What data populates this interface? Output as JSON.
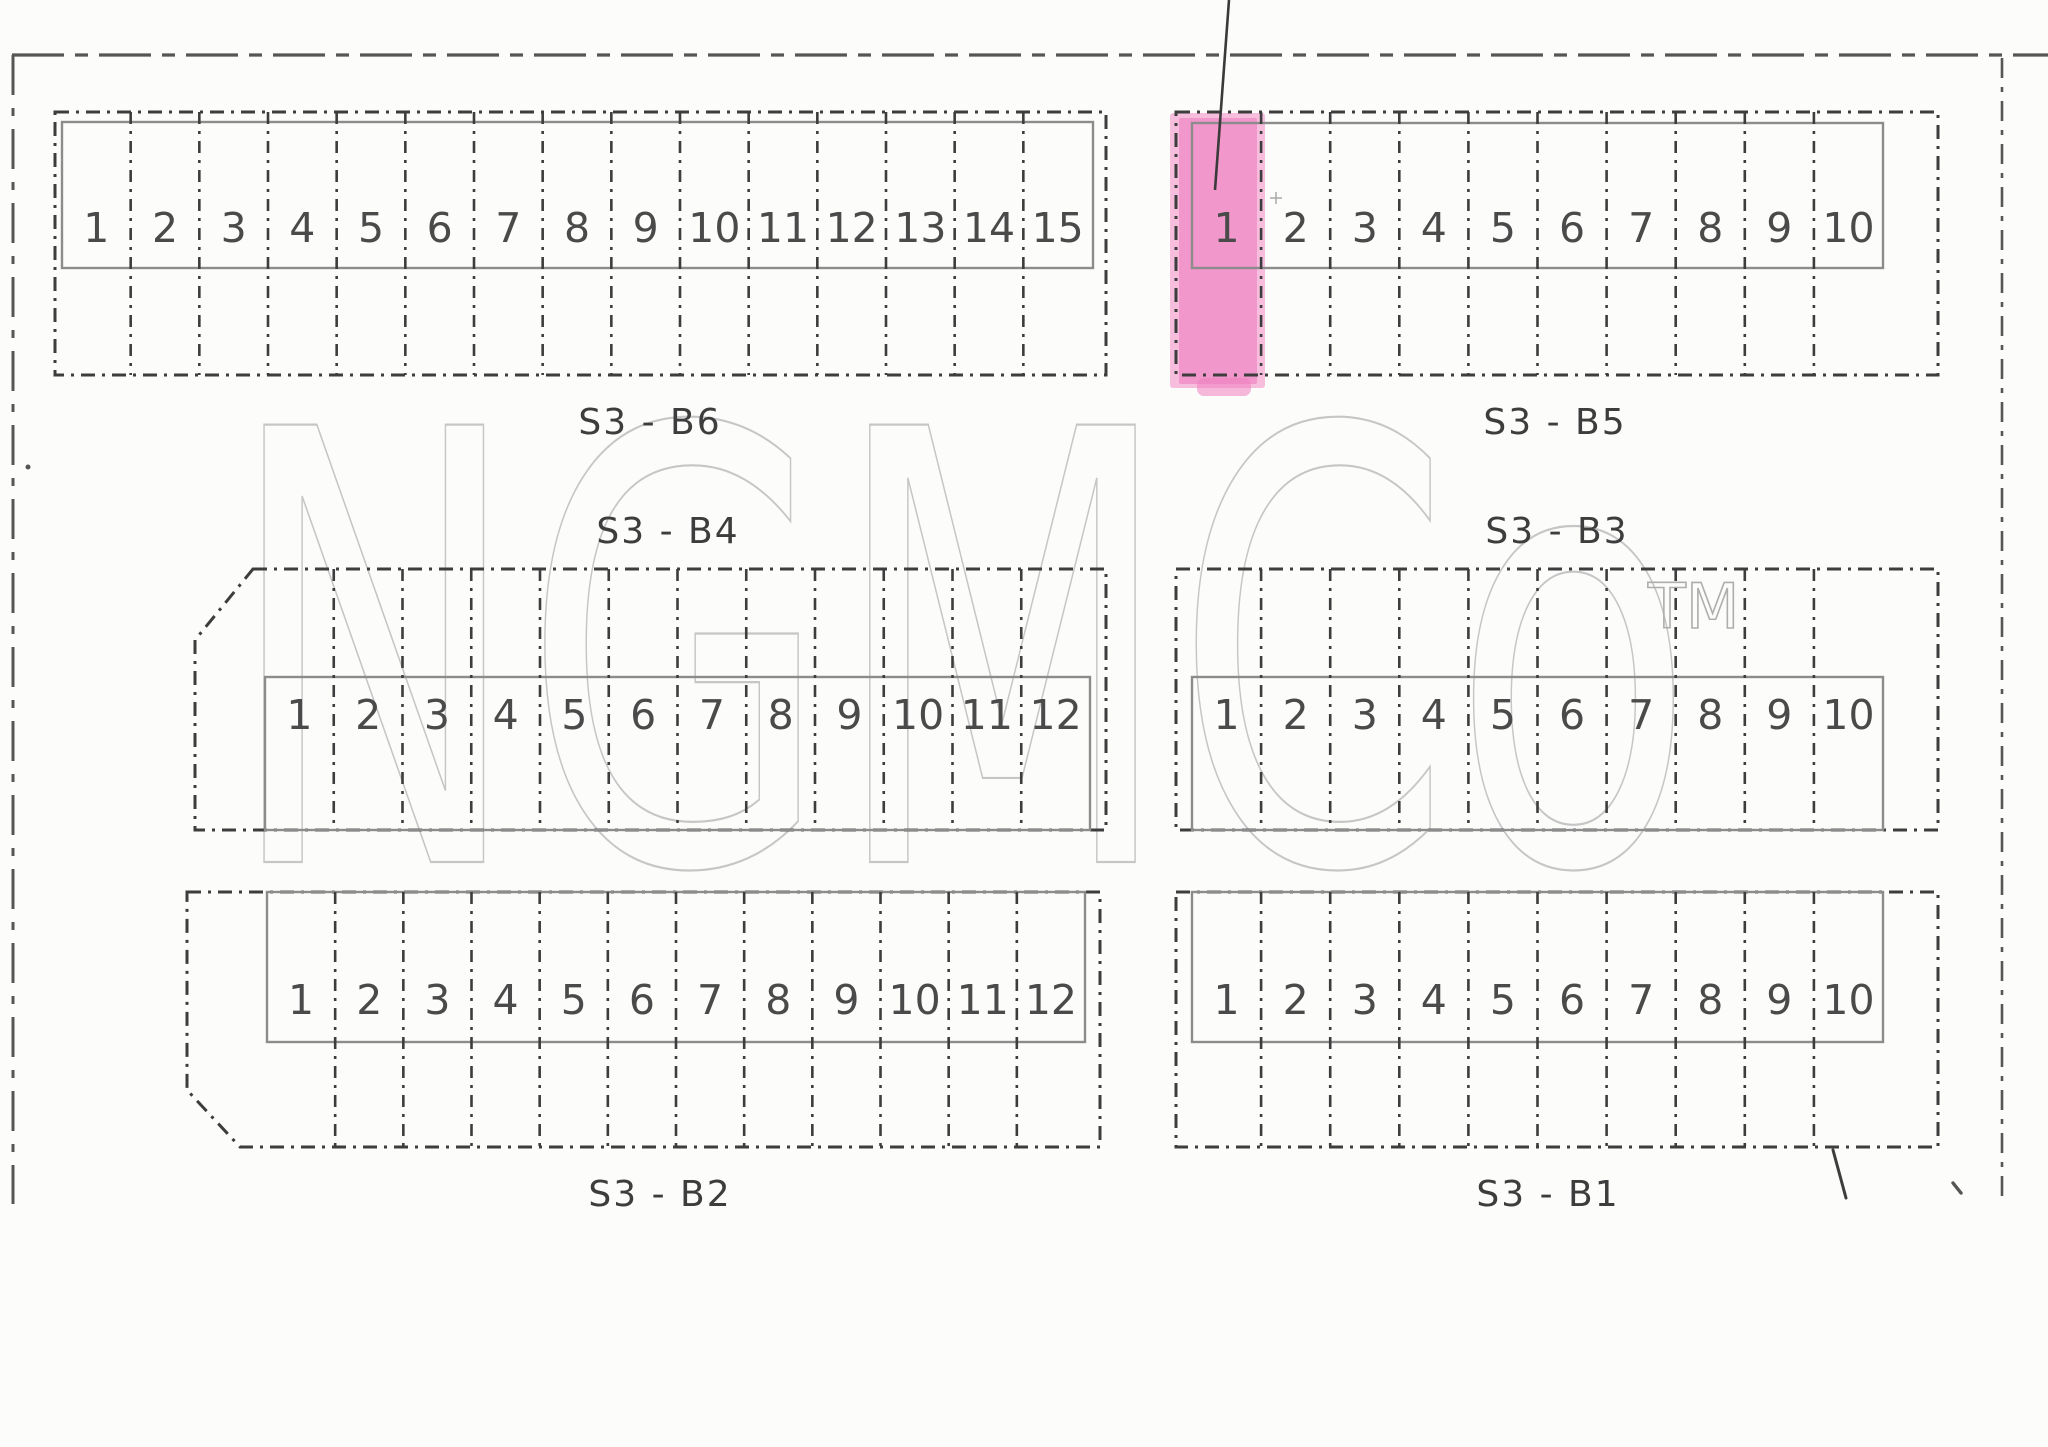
{
  "document": {
    "title": "Lot layout plat – sector S3",
    "background": "#fcfcfb",
    "ink_color": "#3d3d3d",
    "page_border_color": "#565656",
    "inner_rect_color": "#8c8c8c",
    "number_color": "#4a4a4a",
    "label_color": "#3d3d3d"
  },
  "watermark": {
    "text": "NGMCo",
    "tm": "TM",
    "color": "#c6c6c6",
    "tm_color": "#aeaeae",
    "x": 225,
    "baseline_y": 862,
    "font_size": 600,
    "text_length": 1470,
    "tm_x": 1648,
    "tm_baseline_y": 628,
    "tm_font_size": 62
  },
  "highlight": {
    "block": "S3 - B5",
    "lot": "1",
    "outer_color": "#f5a8d2",
    "core_color": "#ef7fc0",
    "outer_rect": [
      1170,
      113,
      1265,
      388
    ],
    "core_rect": [
      1179,
      118,
      1257,
      384
    ],
    "bottom_bump": [
      1197,
      378,
      1251,
      396
    ],
    "leader_line": {
      "x1": 1229,
      "y1": 0,
      "x2": 1215,
      "y2": 190
    }
  },
  "page_border": {
    "top": {
      "x1": 12,
      "y1": 55,
      "x2": 2048,
      "y2": 55
    },
    "left": {
      "x1": 13,
      "y1": 55,
      "x2": 13,
      "y2": 1204
    },
    "right": {
      "x1": 2002,
      "y1": 58,
      "x2": 2002,
      "y2": 1203
    }
  },
  "blocks": [
    {
      "id": "s3-b6",
      "label": "S3 - B6",
      "label_x": 650,
      "label_y": 424,
      "outline": [
        [
          55,
          112
        ],
        [
          1106,
          112
        ],
        [
          1106,
          375
        ],
        [
          55,
          375
        ]
      ],
      "inner_rect": [
        62,
        122,
        1093,
        268
      ],
      "lots": {
        "labels": [
          "1",
          "2",
          "3",
          "4",
          "5",
          "6",
          "7",
          "8",
          "9",
          "10",
          "11",
          "12",
          "13",
          "14",
          "15"
        ],
        "x_start": 62,
        "x_end": 1092,
        "number_y": 231,
        "div_top": 112,
        "div_bottom": 375
      }
    },
    {
      "id": "s3-b5",
      "label": "S3 - B5",
      "label_x": 1555,
      "label_y": 424,
      "outline": [
        [
          1176,
          112
        ],
        [
          1938,
          112
        ],
        [
          1938,
          375
        ],
        [
          1176,
          375
        ]
      ],
      "inner_rect": [
        1192,
        123,
        1883,
        268
      ],
      "lots": {
        "labels": [
          "1",
          "2",
          "3",
          "4",
          "5",
          "6",
          "7",
          "8",
          "9",
          "10"
        ],
        "x_start": 1192,
        "x_end": 1883,
        "number_y": 231,
        "div_top": 112,
        "div_bottom": 375
      }
    },
    {
      "id": "s3-b4",
      "label": "S3 - B4",
      "label_x": 668,
      "label_y": 533,
      "outline": [
        [
          253,
          569
        ],
        [
          1106,
          569
        ],
        [
          1106,
          830
        ],
        [
          195,
          830
        ],
        [
          195,
          640
        ]
      ],
      "inner_rect": [
        265,
        677,
        1090,
        830
      ],
      "lots": {
        "labels": [
          "1",
          "2",
          "3",
          "4",
          "5",
          "6",
          "7",
          "8",
          "9",
          "10",
          "11",
          "12"
        ],
        "x_start": 265,
        "x_end": 1090,
        "number_y": 718,
        "div_top": 569,
        "div_bottom": 830
      }
    },
    {
      "id": "s3-b3",
      "label": "S3 - B3",
      "label_x": 1557,
      "label_y": 533,
      "outline": [
        [
          1176,
          569
        ],
        [
          1938,
          569
        ],
        [
          1938,
          830
        ],
        [
          1176,
          830
        ]
      ],
      "inner_rect": [
        1192,
        677,
        1883,
        830
      ],
      "lots": {
        "labels": [
          "1",
          "2",
          "3",
          "4",
          "5",
          "6",
          "7",
          "8",
          "9",
          "10"
        ],
        "x_start": 1192,
        "x_end": 1883,
        "number_y": 718,
        "div_top": 569,
        "div_bottom": 830
      }
    },
    {
      "id": "s3-b2",
      "label": "S3 - B2",
      "label_x": 660,
      "label_y": 1196,
      "outline": [
        [
          187,
          892
        ],
        [
          1100,
          892
        ],
        [
          1100,
          1147
        ],
        [
          240,
          1147
        ],
        [
          187,
          1090
        ]
      ],
      "inner_rect": [
        267,
        892,
        1085,
        1042
      ],
      "lots": {
        "labels": [
          "1",
          "2",
          "3",
          "4",
          "5",
          "6",
          "7",
          "8",
          "9",
          "10",
          "11",
          "12"
        ],
        "x_start": 267,
        "x_end": 1085,
        "number_y": 1003,
        "div_top": 892,
        "div_bottom": 1147
      }
    },
    {
      "id": "s3-b1",
      "label": "S3 - B1",
      "label_x": 1548,
      "label_y": 1196,
      "outline": [
        [
          1176,
          892
        ],
        [
          1938,
          892
        ],
        [
          1938,
          1147
        ],
        [
          1176,
          1147
        ]
      ],
      "inner_rect": [
        1192,
        892,
        1883,
        1042
      ],
      "lots": {
        "labels": [
          "1",
          "2",
          "3",
          "4",
          "5",
          "6",
          "7",
          "8",
          "9",
          "10"
        ],
        "x_start": 1192,
        "x_end": 1883,
        "number_y": 1003,
        "div_top": 892,
        "div_bottom": 1147
      }
    }
  ],
  "marks": {
    "diagonal_tick": {
      "x1": 1833,
      "y1": 1150,
      "x2": 1846,
      "y2": 1198
    },
    "comma": {
      "x1": 1953,
      "y1": 1183,
      "x2": 1961,
      "y2": 1193
    },
    "period": {
      "cx": 28,
      "cy": 467,
      "r": 2.5
    },
    "small_plus": {
      "cx": 1276,
      "cy": 198,
      "r": 6
    }
  },
  "style_numbers": {
    "lot_font_size": 41,
    "label_font_size": 36
  }
}
